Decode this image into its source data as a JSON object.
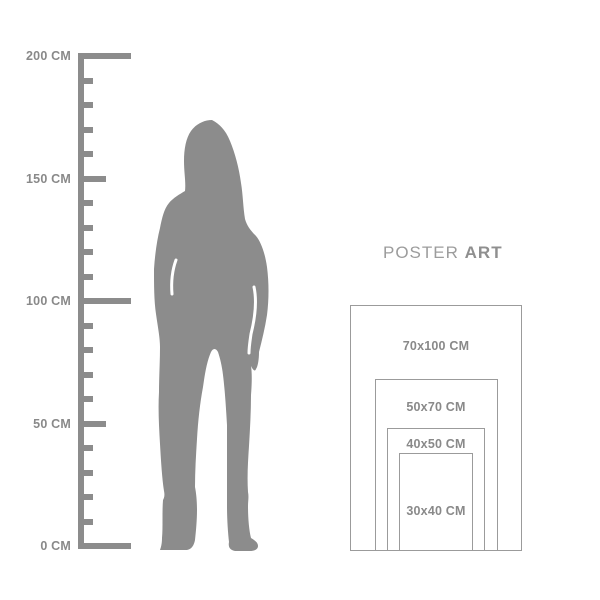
{
  "page": {
    "background": "#ffffff",
    "description_name": "poster-size-guide-diagram"
  },
  "ruler": {
    "unit": "CM",
    "max_cm": 200,
    "color": "#8c8c8c",
    "label_color": "#898989",
    "labeled_ticks": [
      {
        "cm": 200,
        "label": "200 CM"
      },
      {
        "cm": 150,
        "label": "150 CM"
      },
      {
        "cm": 100,
        "label": "100 CM"
      },
      {
        "cm": 50,
        "label": "50 CM"
      },
      {
        "cm": 0,
        "label": "0 CM"
      }
    ],
    "minor_ticks_cm": [
      10,
      20,
      30,
      40,
      60,
      70,
      80,
      90,
      110,
      120,
      130,
      140,
      160,
      170,
      180,
      190
    ]
  },
  "figure": {
    "kind": "standing-woman-silhouette",
    "color": "#8c8c8c"
  },
  "poster_guide": {
    "title": {
      "regular": "POSTER",
      "bold": "ART"
    },
    "title_regular_color": "#9c9c9c",
    "title_bold_color": "#8f8f8f",
    "border_color": "#9b9b9b",
    "label_color": "#898989",
    "sizes": [
      {
        "label": "70x100 CM",
        "width_cm": 70,
        "height_cm": 100
      },
      {
        "label": "50x70 CM",
        "width_cm": 50,
        "height_cm": 70
      },
      {
        "label": "40x50 CM",
        "width_cm": 40,
        "height_cm": 50
      },
      {
        "label": "30x40 CM",
        "width_cm": 30,
        "height_cm": 40
      }
    ]
  }
}
